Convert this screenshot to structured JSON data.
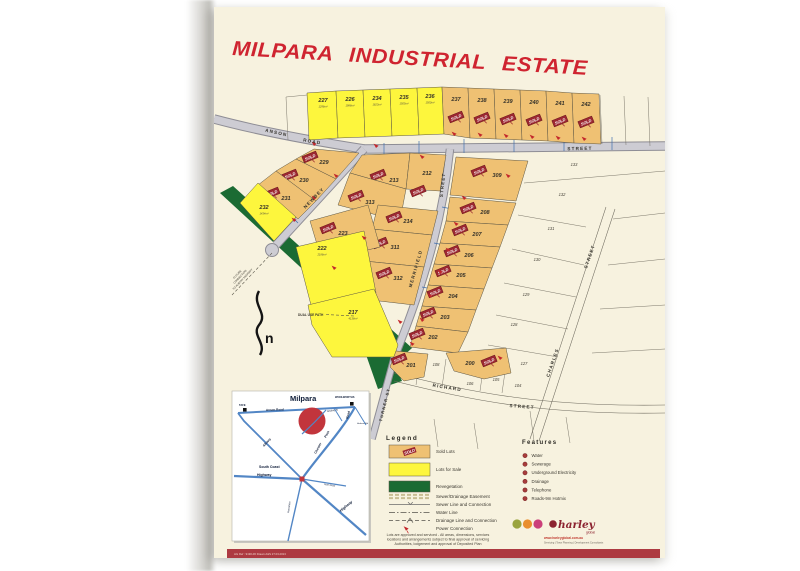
{
  "title": "MILPARA INDUSTRIAL ESTATE",
  "colors": {
    "sale": "#fdf63d",
    "sold": "#efc173",
    "reveg": "#1b6b33",
    "road_fill": "#cdccd3",
    "road_edge": "#8e8d95",
    "banner": "#9c2731",
    "accent_red": "#c3272b",
    "footer_bar": "#ad3a41",
    "inset_road": "#5286c5",
    "inset_red": "#c2353c"
  },
  "map": {
    "sold_banner_text": "SOLD",
    "streets": [
      {
        "t": "ANSON",
        "x": 62,
        "y": 127,
        "r": 13,
        "s": 4.6
      },
      {
        "t": "ROAD",
        "x": 98,
        "y": 136,
        "r": 10,
        "s": 4.6
      },
      {
        "t": "STREET",
        "x": 366,
        "y": 143,
        "r": -1,
        "s": 4.6
      },
      {
        "t": "NEWBEY",
        "x": 101,
        "y": 192,
        "r": -46,
        "s": 4.6
      },
      {
        "t": "STREET",
        "x": 230,
        "y": 178,
        "r": -84,
        "s": 4.4
      },
      {
        "t": "MERRIFIELD",
        "x": 203,
        "y": 262,
        "r": -74,
        "s": 4.4
      },
      {
        "t": "TURNER ST",
        "x": 172,
        "y": 398,
        "r": -76,
        "s": 4.1
      },
      {
        "t": "RICHARD",
        "x": 233,
        "y": 382,
        "r": 9,
        "s": 4.6
      },
      {
        "t": "STREET",
        "x": 308,
        "y": 401,
        "r": 4,
        "s": 4.6
      },
      {
        "t": "CHARLES",
        "x": 340,
        "y": 356,
        "r": -71,
        "s": 4.5
      },
      {
        "t": "STREET",
        "x": 377,
        "y": 250,
        "r": -71,
        "s": 4.5
      }
    ],
    "lots": [
      {
        "n": "227",
        "s": "sale",
        "x": 109,
        "y": 95,
        "area": "1296m²",
        "poly": "93,86 122,84 124,131 95,133"
      },
      {
        "n": "226",
        "s": "sale",
        "x": 136,
        "y": 94,
        "area": "1988m²",
        "poly": "122,84 149,83 151,130 124,131"
      },
      {
        "n": "234",
        "s": "sale",
        "x": 163,
        "y": 93,
        "area": "1623m²",
        "poly": "149,83 176,82 178,129 151,130"
      },
      {
        "n": "235",
        "s": "sale",
        "x": 190,
        "y": 92,
        "area": "1505m²",
        "poly": "176,82 203,81 205,128 178,129"
      },
      {
        "n": "236",
        "s": "sale",
        "x": 216,
        "y": 91,
        "area": "1500m²",
        "poly": "203,81 228,80 230,127 205,128"
      },
      {
        "n": "237",
        "s": "sold",
        "x": 242,
        "y": 94,
        "bx": 242,
        "by": 110,
        "poly": "228,80 254,81 256,131 230,127"
      },
      {
        "n": "238",
        "s": "sold",
        "x": 268,
        "y": 95,
        "bx": 268,
        "by": 111,
        "poly": "254,81 280,82 282,132 256,131"
      },
      {
        "n": "239",
        "s": "sold",
        "x": 294,
        "y": 96,
        "bx": 294,
        "by": 112,
        "poly": "280,82 306,83 308,133 282,132"
      },
      {
        "n": "240",
        "s": "sold",
        "x": 320,
        "y": 97,
        "bx": 320,
        "by": 113,
        "poly": "306,83 332,84 334,134 308,133"
      },
      {
        "n": "241",
        "s": "sold",
        "x": 346,
        "y": 98,
        "bx": 346,
        "by": 114,
        "poly": "332,84 358,86 360,136 334,134"
      },
      {
        "n": "242",
        "s": "sold",
        "x": 372,
        "y": 99,
        "bx": 372,
        "by": 115,
        "poly": "358,86 385,87 387,137 360,136"
      },
      {
        "n": "229",
        "s": "sold",
        "x": 110,
        "y": 157,
        "bx": 96,
        "by": 150,
        "poly": "100,142 145,146 122,172 82,152"
      },
      {
        "n": "230",
        "s": "sold",
        "x": 90,
        "y": 175,
        "bx": 76,
        "by": 168,
        "poly": "82,152 122,172 102,194 62,164"
      },
      {
        "n": "231",
        "s": "sold",
        "x": 72,
        "y": 193,
        "bx": 58,
        "by": 186,
        "poly": "62,164 102,194 84,212 44,178"
      },
      {
        "n": "232",
        "s": "sale",
        "x": 50,
        "y": 202,
        "area": "1434m²",
        "poly": "44,176 82,210 60,234 26,196"
      },
      {
        "n": "213",
        "s": "sold",
        "x": 180,
        "y": 175,
        "bx": 164,
        "by": 168,
        "poly": "148,148 196,146 192,182 136,166"
      },
      {
        "n": "212",
        "s": "sold",
        "x": 213,
        "y": 168,
        "bx": 204,
        "by": 184,
        "poly": "196,146 232,148 226,184 192,182"
      },
      {
        "n": "313",
        "s": "sold",
        "x": 156,
        "y": 197,
        "bx": 142,
        "by": 189,
        "poly": "136,166 192,182 186,214 124,198"
      },
      {
        "n": "214",
        "s": "sold",
        "x": 194,
        "y": 216,
        "bx": 180,
        "by": 210,
        "poly": "164,198 224,204 218,228 158,222"
      },
      {
        "n": "311",
        "s": "sold",
        "x": 181,
        "y": 242,
        "bx": 166,
        "by": 236,
        "poly": "158,222 218,228 210,260 150,254"
      },
      {
        "n": "312",
        "s": "sold",
        "x": 184,
        "y": 273,
        "bx": 170,
        "by": 266,
        "poly": "150,254 210,260 200,298 148,292"
      },
      {
        "n": "223",
        "s": "sold",
        "x": 129,
        "y": 228,
        "bx": 114,
        "by": 221,
        "poly": "96,214 154,198 166,240 108,254"
      },
      {
        "n": "222",
        "s": "sale",
        "x": 108,
        "y": 243,
        "area": "2186m²",
        "poly": "82,240 150,224 162,286 98,302"
      },
      {
        "n": "217",
        "s": "sale",
        "x": 139,
        "y": 307,
        "area": "4138m²",
        "poly": "94,298 160,282 184,338 180,350 118,350 98,318"
      },
      {
        "n": "309",
        "s": "sold",
        "x": 283,
        "y": 170,
        "bx": 265,
        "by": 164,
        "poly": "242,150 314,154 302,194 236,188"
      },
      {
        "n": "208",
        "s": "sold",
        "x": 271,
        "y": 207,
        "bx": 254,
        "by": 201,
        "poly": "236,190 302,196 294,218 232,214"
      },
      {
        "n": "207",
        "s": "sold",
        "x": 263,
        "y": 229,
        "bx": 246,
        "by": 223,
        "poly": "232,214 294,218 286,240 226,236"
      },
      {
        "n": "206",
        "s": "sold",
        "x": 255,
        "y": 250,
        "bx": 238,
        "by": 244,
        "poly": "226,236 286,240 278,261 220,257"
      },
      {
        "n": "205",
        "s": "sold",
        "x": 247,
        "y": 270,
        "bx": 229,
        "by": 264,
        "poly": "220,257 278,261 270,282 214,278"
      },
      {
        "n": "204",
        "s": "sold",
        "x": 239,
        "y": 291,
        "bx": 221,
        "by": 285,
        "poly": "214,278 270,282 262,303 208,299"
      },
      {
        "n": "203",
        "s": "sold",
        "x": 231,
        "y": 312,
        "bx": 214,
        "by": 306,
        "poly": "208,299 262,303 254,325 202,319"
      },
      {
        "n": "202",
        "s": "sold",
        "x": 219,
        "y": 332,
        "bx": 203,
        "by": 327,
        "poly": "202,319 254,325 244,346 196,340"
      },
      {
        "n": "201",
        "s": "sold",
        "x": 197,
        "y": 360,
        "bx": 185,
        "by": 352,
        "poly": "182,344 214,347 210,370 190,374 176,360"
      },
      {
        "n": "200",
        "s": "sold",
        "x": 256,
        "y": 358,
        "bx": 275,
        "by": 354,
        "poly": "232,346 292,341 297,366 270,372 240,364"
      },
      {
        "n": "133",
        "s": "plain",
        "x": 360,
        "y": 159
      },
      {
        "n": "132",
        "s": "plain",
        "x": 348,
        "y": 189
      },
      {
        "n": "131",
        "s": "plain",
        "x": 337,
        "y": 223
      },
      {
        "n": "130",
        "s": "plain",
        "x": 323,
        "y": 254
      },
      {
        "n": "129",
        "s": "plain",
        "x": 312,
        "y": 289
      },
      {
        "n": "128",
        "s": "plain",
        "x": 300,
        "y": 319
      },
      {
        "n": "127",
        "s": "plain",
        "x": 310,
        "y": 358
      },
      {
        "n": "108",
        "s": "plain",
        "x": 222,
        "y": 359
      },
      {
        "n": "106",
        "s": "plain",
        "x": 256,
        "y": 378
      },
      {
        "n": "105",
        "s": "plain",
        "x": 282,
        "y": 374
      },
      {
        "n": "104",
        "s": "plain",
        "x": 304,
        "y": 380
      }
    ],
    "power_arrows": [
      [
        100,
        139
      ],
      [
        162,
        141
      ],
      [
        208,
        152
      ],
      [
        122,
        171
      ],
      [
        100,
        193
      ],
      [
        80,
        215
      ],
      [
        150,
        233
      ],
      [
        120,
        263
      ],
      [
        186,
        317
      ],
      [
        240,
        129
      ],
      [
        266,
        130
      ],
      [
        292,
        131
      ],
      [
        318,
        132
      ],
      [
        344,
        133
      ],
      [
        370,
        134
      ],
      [
        250,
        193
      ],
      [
        242,
        219
      ],
      [
        234,
        245
      ],
      [
        226,
        267
      ],
      [
        216,
        291
      ],
      [
        208,
        315
      ],
      [
        198,
        339
      ],
      [
        286,
        353
      ],
      [
        294,
        171
      ]
    ]
  },
  "notes": {
    "dual_use_path": "DUAL USE PATH",
    "future": [
      "FUTURE",
      "CONNECTION",
      "TO ALBANY HIGHWAY"
    ],
    "north": "n"
  },
  "legend": {
    "title": "Legend",
    "items": [
      {
        "sym": "sold",
        "label": "Sold Lots"
      },
      {
        "sym": "sale",
        "label": "Lots for Sale"
      },
      {
        "sym": "reveg",
        "label": "Revegetation"
      },
      {
        "sym": "easement",
        "label": "Sewer/Drainage Easement"
      },
      {
        "sym": "sewer",
        "label": "Sewer Line and Connection"
      },
      {
        "sym": "water",
        "label": "Water Line"
      },
      {
        "sym": "drain",
        "label": "Drainage Line and Connection"
      },
      {
        "sym": "power",
        "label": "Power Connection"
      }
    ]
  },
  "features": {
    "title": "Features",
    "items": [
      "Water",
      "Sewerage",
      "Underground Electricity",
      "Drainage",
      "Telephone",
      "Roads-9m Hotmix"
    ]
  },
  "inset": {
    "labels": [
      {
        "t": "Milpara",
        "x": 76,
        "y": 394,
        "s": 7.5,
        "b": 1,
        "c": "#111111"
      },
      {
        "t": "WOOLWORTHS",
        "x": 121,
        "y": 391,
        "s": 2.6,
        "b": 1
      },
      {
        "t": "TAFE",
        "x": 25,
        "y": 399,
        "s": 2.6,
        "b": 1
      },
      {
        "t": "Anson Road",
        "x": 52,
        "y": 404,
        "s": 3,
        "b": 1,
        "r": -2
      },
      {
        "t": "Newbey St",
        "x": 113,
        "y": 405,
        "s": 2.3,
        "r": -8
      },
      {
        "t": "Hudson Rd",
        "x": 143,
        "y": 417,
        "s": 2.2
      },
      {
        "t": "Albany",
        "x": 50,
        "y": 440,
        "s": 3.2,
        "b": 1,
        "r": -48
      },
      {
        "t": "Chester",
        "x": 102,
        "y": 447,
        "s": 3.2,
        "b": 1,
        "r": -62
      },
      {
        "t": "Pass",
        "x": 112,
        "y": 431,
        "s": 3.2,
        "b": 1,
        "r": -62
      },
      {
        "t": "Road",
        "x": 134,
        "y": 412,
        "s": 3.2,
        "b": 1,
        "r": -75
      },
      {
        "t": "South Coast",
        "x": 45,
        "y": 461,
        "s": 3.5,
        "b": 1
      },
      {
        "t": "Highway",
        "x": 43,
        "y": 469,
        "s": 3.5,
        "b": 1
      },
      {
        "t": "North Road",
        "x": 110,
        "y": 478,
        "s": 2.2,
        "r": 8
      },
      {
        "t": "Hanrahan",
        "x": 75,
        "y": 506,
        "s": 2.6,
        "r": -82
      },
      {
        "t": "Highway",
        "x": 127,
        "y": 505,
        "s": 3.7,
        "b": 1,
        "i": 1,
        "r": -40
      }
    ]
  },
  "logo": {
    "name": "harley",
    "sub": "global",
    "url": "www.harleyglobal.com.au",
    "tagline": "Servicing | Town Planning | Development Consultants"
  },
  "disclaimer": [
    "Lots are approved and serviced - All areas, dimensions, services",
    "locations and arrangements subject to final approval of servicing",
    "Authorities, lodgement and approval of Deposited Plan"
  ],
  "footer": {
    "text": "HG Ref : 9190-06      Drawn A&S 27.03.2013"
  }
}
